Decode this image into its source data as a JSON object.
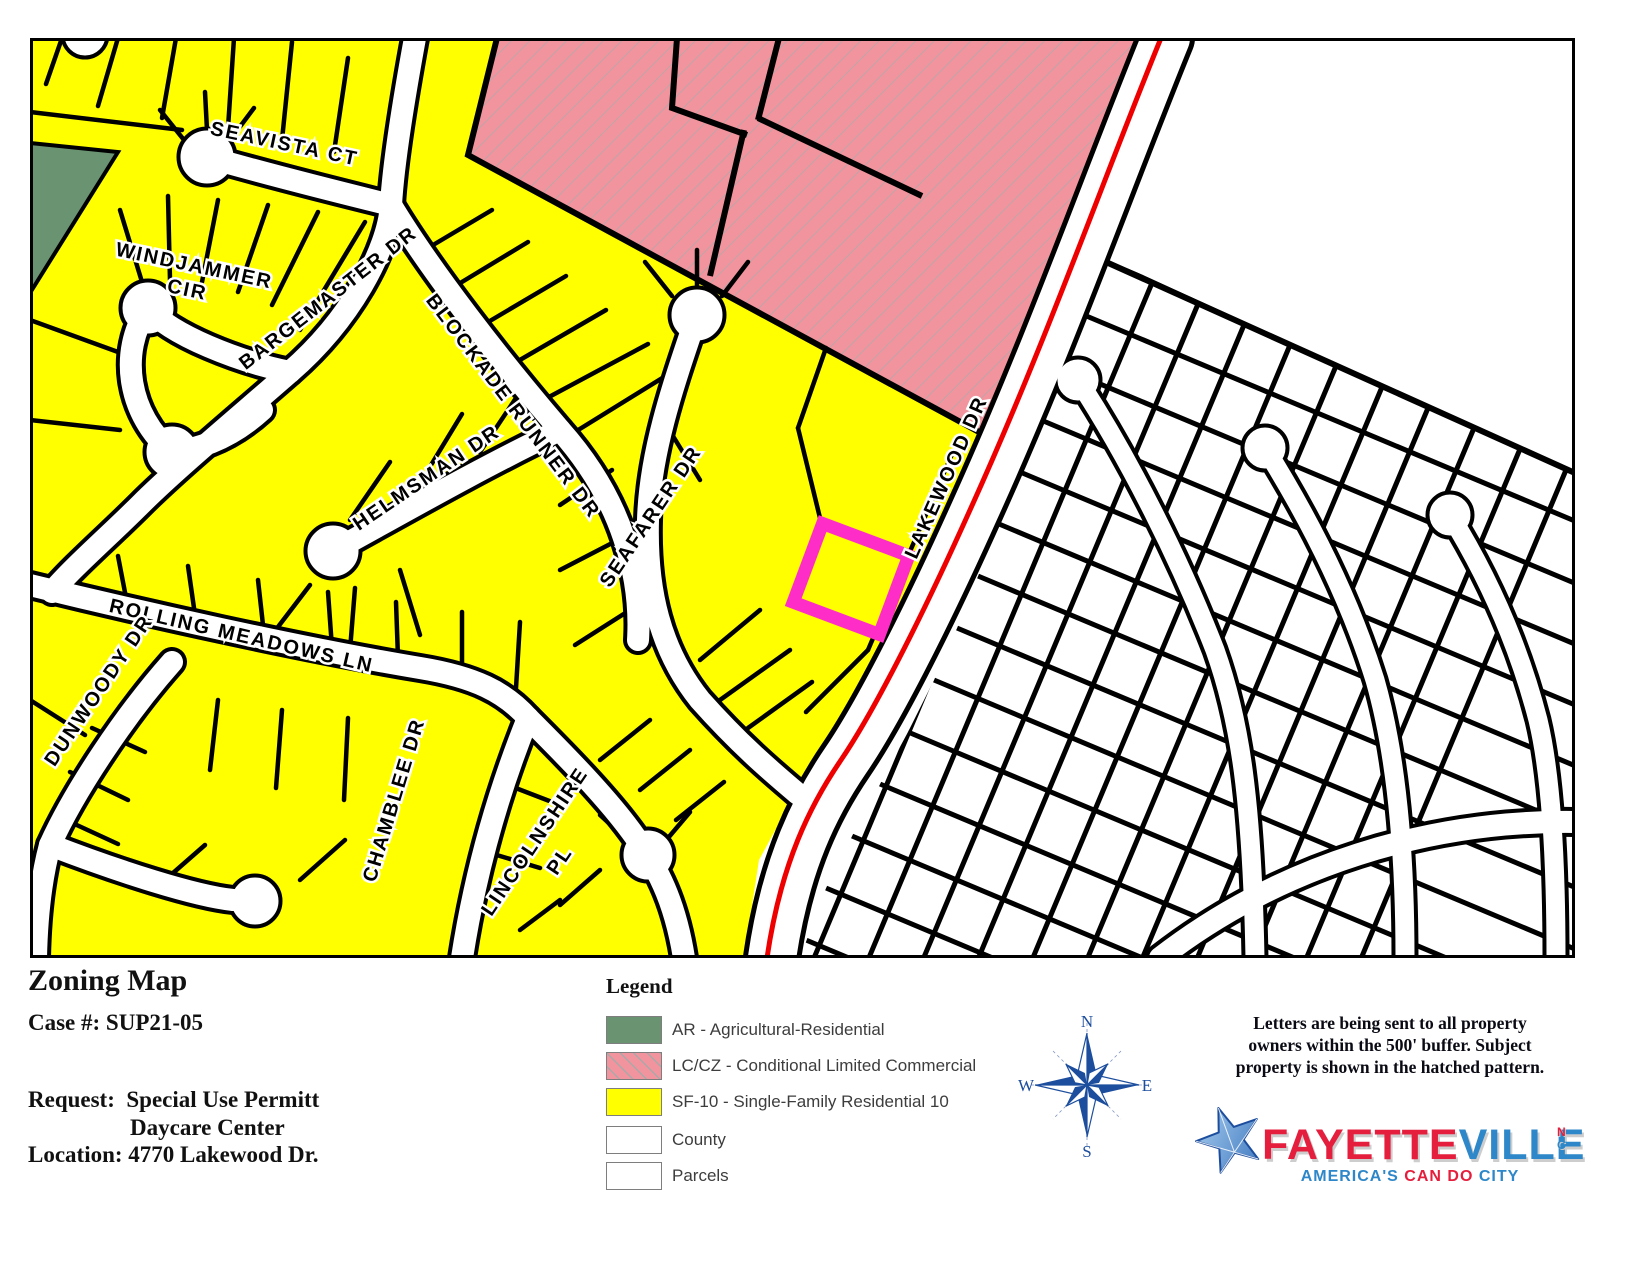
{
  "info_panel": {
    "title": "Zoning Map",
    "case_line": "Case #: SUP21-05",
    "request_label": "Request:",
    "request_value_line1": "Special Use Permitt",
    "request_value_line2": "Daycare Center",
    "location_line": "Location: 4770 Lakewood Dr."
  },
  "legend": {
    "title": "Legend",
    "items": [
      {
        "label": "AR - Agricultural-Residential",
        "color": "#6A9372",
        "hatched": false
      },
      {
        "label": "LC/CZ - Conditional Limited Commercial",
        "color": "#F2949D",
        "hatched": true
      },
      {
        "label": "SF-10 - Single-Family Residential 10",
        "color": "#FFFF00",
        "hatched": false
      },
      {
        "label": "County",
        "color": "#FFFFFF",
        "hatched": false
      },
      {
        "label": "Parcels",
        "color": "#FFFFFF",
        "hatched": false
      }
    ]
  },
  "compass": {
    "north": "N",
    "east": "E",
    "south": "S",
    "west": "W"
  },
  "note": {
    "line1": "Letters are being sent to all property",
    "line2": "owners within the 500' buffer.  Subject",
    "line3": "property is shown in the hatched pattern."
  },
  "logo": {
    "name_part1": "FAYETTE",
    "name_part2": "VILLE",
    "state_top": "N",
    "state_bottom": "C",
    "tagline_part1": "AMERICA'S ",
    "tagline_part2": "CAN DO ",
    "tagline_part3": "CITY",
    "colors": {
      "red": "#E41E3C",
      "blue": "#2D87C8",
      "star_blue": "#1D4E9E"
    }
  },
  "map": {
    "colors": {
      "sf10_yellow": "#FFFF00",
      "commercial_pink": "#F2949D",
      "agricultural_green": "#6A9372",
      "county_white": "#FFFFFF",
      "highlight_red": "#EE0000",
      "subject_magenta": "#FF2DC8",
      "parcel_line": "#000000"
    },
    "streets": {
      "seavista": "SEAVISTA CT",
      "windjammer_line1": "WINDJAMMER",
      "windjammer_line2": "CIR",
      "bargemaster": "BARGEMASTER DR",
      "blockade_runner": "BLOCKADE RUNNER DR",
      "helmsman": "HELMSMAN DR",
      "seafarer": "SEAFARER DR",
      "lakewood": "LAKEWOOD DR",
      "rolling_meadows": "ROLLING MEADOWS LN",
      "dunwoody": "DUNWOODY DR",
      "chamblee": "CHAMBLEE DR",
      "lincolnshire_line1": "LINCOLNSHIRE",
      "lincolnshire_line2": "PL"
    }
  }
}
